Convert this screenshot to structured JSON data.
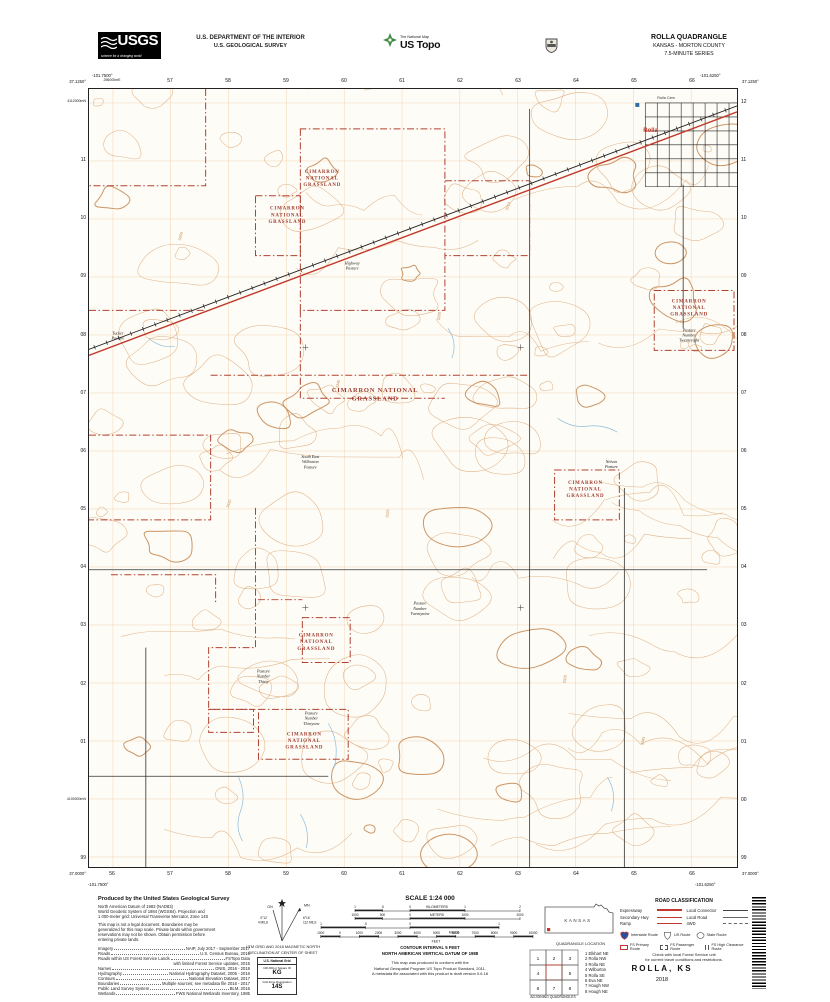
{
  "header": {
    "usgs_logo": "USGS",
    "usgs_tagline": "science for a changing world",
    "dept_line1": "U.S. DEPARTMENT OF THE INTERIOR",
    "dept_line2": "U.S. GEOLOGICAL SURVEY",
    "tnm_brand": "The National Map",
    "ustopo": "US Topo",
    "quad_title": "ROLLA QUADRANGLE",
    "quad_state": "KANSAS - MORTON COUNTY",
    "quad_series": "7.5-MINUTE SERIES"
  },
  "map": {
    "corners": {
      "tl_lon": "-101.7500°",
      "tl_lat": "37.1250°",
      "tr_lon": "-101.6250°",
      "tr_lat": "37.1250°",
      "bl_lat": "37.0000°",
      "bl_lon": "-101.7500°",
      "br_lat": "37.0000°",
      "br_lon": "-101.6250°"
    },
    "grid": {
      "eastings_top": [
        "256000mE",
        "57",
        "58",
        "59",
        "60",
        "61",
        "62",
        "63",
        "64",
        "65",
        "66"
      ],
      "eastings_bottom": [
        "56",
        "57",
        "58",
        "59",
        "60",
        "61",
        "62",
        "63",
        "64",
        "65",
        "66"
      ],
      "northings_left": [
        "4112000mN",
        "11",
        "10",
        "09",
        "08",
        "07",
        "06",
        "05",
        "04",
        "03",
        "02",
        "01",
        "4100000mN",
        "99"
      ],
      "northings_right": [
        "12",
        "11",
        "10",
        "09",
        "08",
        "07",
        "06",
        "05",
        "04",
        "03",
        "02",
        "01",
        "00",
        "99"
      ]
    },
    "area_labels": [
      {
        "x": 234,
        "y": 84,
        "size": 5,
        "lines": [
          "CIMARRON",
          "NATIONAL",
          "GRASSLAND"
        ]
      },
      {
        "x": 199,
        "y": 121,
        "size": 5,
        "lines": [
          "CIMARRON",
          "NATIONAL",
          "GRASSLAND"
        ]
      },
      {
        "x": 287,
        "y": 304,
        "size": 6.5,
        "lines": [
          "CIMARRON NATIONAL",
          "GRASSLAND"
        ]
      },
      {
        "x": 602,
        "y": 214,
        "size": 5,
        "lines": [
          "CIMARRON",
          "NATIONAL",
          "GRASSLAND"
        ]
      },
      {
        "x": 498,
        "y": 396,
        "size": 5,
        "lines": [
          "CIMARRON",
          "NATIONAL",
          "GRASSLAND"
        ]
      },
      {
        "x": 228,
        "y": 549,
        "size": 5,
        "lines": [
          "CIMARRON",
          "NATIONAL",
          "GRASSLAND"
        ]
      },
      {
        "x": 216,
        "y": 648,
        "size": 5,
        "lines": [
          "CIMARRON",
          "NATIONAL",
          "GRASSLAND"
        ]
      }
    ],
    "pasture_labels": [
      {
        "x": 29,
        "y": 246,
        "lines": [
          "Tucker",
          "Pasture"
        ]
      },
      {
        "x": 264,
        "y": 176,
        "lines": [
          "Highway",
          "Pasture"
        ]
      },
      {
        "x": 222,
        "y": 370,
        "lines": [
          "South East",
          "Wilburton",
          "Pasture"
        ]
      },
      {
        "x": 524,
        "y": 375,
        "lines": [
          "Nelson",
          "Pasture"
        ]
      },
      {
        "x": 602,
        "y": 243,
        "lines": [
          "Pasture",
          "Number",
          "Twentyeight"
        ]
      },
      {
        "x": 332,
        "y": 517,
        "lines": [
          "Pasture",
          "Number",
          "Twentynine"
        ]
      },
      {
        "x": 175,
        "y": 585,
        "lines": [
          "Pasture",
          "Number",
          "Thirty"
        ]
      },
      {
        "x": 223,
        "y": 627,
        "lines": [
          "Pasture",
          "Number",
          "Thirtyone"
        ]
      }
    ],
    "place_labels": [
      {
        "x": 556,
        "y": 43,
        "text": "Rolla",
        "color": "#c0392b",
        "size": 6,
        "bold": true
      },
      {
        "x": 570,
        "y": 10,
        "text": "Rolla Cem",
        "color": "#333",
        "size": 3.8,
        "bold": false
      }
    ],
    "spot_elevations": [
      {
        "x": 250,
        "y": 300,
        "a": -78,
        "text": "3340"
      },
      {
        "x": 352,
        "y": 232,
        "a": -85,
        "text": "3335"
      },
      {
        "x": 140,
        "y": 420,
        "a": -70,
        "text": "3330"
      },
      {
        "x": 478,
        "y": 596,
        "a": -82,
        "text": "3320"
      },
      {
        "x": 92,
        "y": 152,
        "a": -75,
        "text": "3350"
      },
      {
        "x": 556,
        "y": 658,
        "a": -78,
        "text": "3345"
      },
      {
        "x": 420,
        "y": 122,
        "a": -70,
        "text": "3310"
      },
      {
        "x": 300,
        "y": 430,
        "a": -80,
        "text": "3325"
      }
    ]
  },
  "collar": {
    "produced": {
      "title": "Produced by the United States Geological Survey",
      "para1": [
        "North American Datum of 1983 (NAD83)",
        "World Geodetic System of 1984 (WGS84).  Projection and",
        "1 000-meter grid: Universal Transverse Mercator, Zone 14S"
      ],
      "para2": [
        "This map is not a legal document. Boundaries may be",
        "generalized for this map scale. Private lands within government",
        "reservations may not be shown. Obtain permission before",
        "entering private lands."
      ],
      "sources": [
        {
          "k": "Imagery",
          "v": "NAIP, July 2017 - September 2017"
        },
        {
          "k": "Roads",
          "v": "U.S. Census Bureau, 2016"
        },
        {
          "k": "Roads within US Forest Service Lands",
          "v": "FSTopo Data"
        },
        {
          "k": "",
          "v": "with limited Forest Service updates, 2015"
        },
        {
          "k": "Names",
          "v": "GNIS, 2016 - 2018"
        },
        {
          "k": "Hydrography",
          "v": "National Hydrography Dataset, 2005 - 2016"
        },
        {
          "k": "Contours",
          "v": "National Elevation Dataset, 2017"
        },
        {
          "k": "Boundaries",
          "v": "Multiple sources; see metadata file 2016 - 2017"
        },
        {
          "k": "Public Land Survey System",
          "v": "BLM, 2016"
        },
        {
          "k": "Wetlands",
          "v": "FWS National Wetlands Inventory, 1985"
        }
      ]
    },
    "declination": {
      "gn": "GN",
      "mn": "MN",
      "gn_deg": "0°12´",
      "gn_mils": "4 MILS",
      "mn_deg": "6°16´",
      "mn_mils": "112 MILS",
      "caption1": "UTM GRID AND 2018 MAGNETIC NORTH",
      "caption2": "DECLINATION AT CENTER OF SHEET"
    },
    "usng": {
      "title": "U.S. National Grid",
      "sq_label": "100,000-m Square ID",
      "sq": "KG",
      "zone_label": "Grid Zone Designation",
      "zone": "14S"
    },
    "scale": {
      "title": "SCALE 1:24 000",
      "rows": [
        {
          "unit": "KILOMETERS",
          "ticks": [
            "1",
            ".5",
            "0",
            "1",
            "2"
          ]
        },
        {
          "unit": "METERS",
          "ticks": [
            "1000",
            "500",
            "0",
            "1000",
            "2000"
          ]
        },
        {
          "unit": "MILES",
          "ticks": [
            "1",
            ".5",
            "0",
            "1"
          ]
        },
        {
          "unit": "FEET",
          "ticks": [
            "1000",
            "0",
            "1000",
            "2000",
            "3000",
            "4000",
            "5000",
            "6000",
            "7000",
            "8000",
            "9000",
            "10000"
          ]
        }
      ],
      "contour1": "CONTOUR INTERVAL 5 FEET",
      "contour2": "NORTH AMERICAN VERTICAL DATUM OF 1988",
      "conf1": "This map was produced to conform with the",
      "conf2": "National Geospatial Program US Topo Product Standard, 2011.",
      "conf3": "A metadata file associated with this product is draft version 0.6.18"
    },
    "location": {
      "state": "KANSAS",
      "caption": "QUADRANGLE LOCATION",
      "adj_caption": "ADJOINING QUADRANGLES",
      "adjoining": [
        "1 Elkhart NE",
        "2 Rolla NW",
        "3 Rolla NE",
        "4 Wilburton",
        "5 Rolla SE",
        "6 Eva NE",
        "7 Hough NW",
        "8 Hough NE"
      ]
    },
    "roads": {
      "title": "ROAD CLASSIFICATION",
      "left": [
        {
          "label": "Expressway",
          "style": "expressway"
        },
        {
          "label": "Secondary Hwy",
          "style": "secondary"
        },
        {
          "label": "Ramp",
          "style": "ramp"
        }
      ],
      "right": [
        {
          "label": "Local Connector",
          "style": "connector"
        },
        {
          "label": "Local Road",
          "style": "local"
        },
        {
          "label": "4WD",
          "style": "fourwd"
        }
      ],
      "shields": [
        "Interstate Route",
        "US Route",
        "State Route"
      ],
      "fs": [
        "FS Primary Route",
        "FS Passenger Route",
        "FS High Clearance Route"
      ],
      "note1": "Check with local Forest Service unit",
      "note2": "for current travel conditions and restrictions."
    },
    "title_block": {
      "name": "ROLLA,  KS",
      "year": "2018"
    }
  }
}
